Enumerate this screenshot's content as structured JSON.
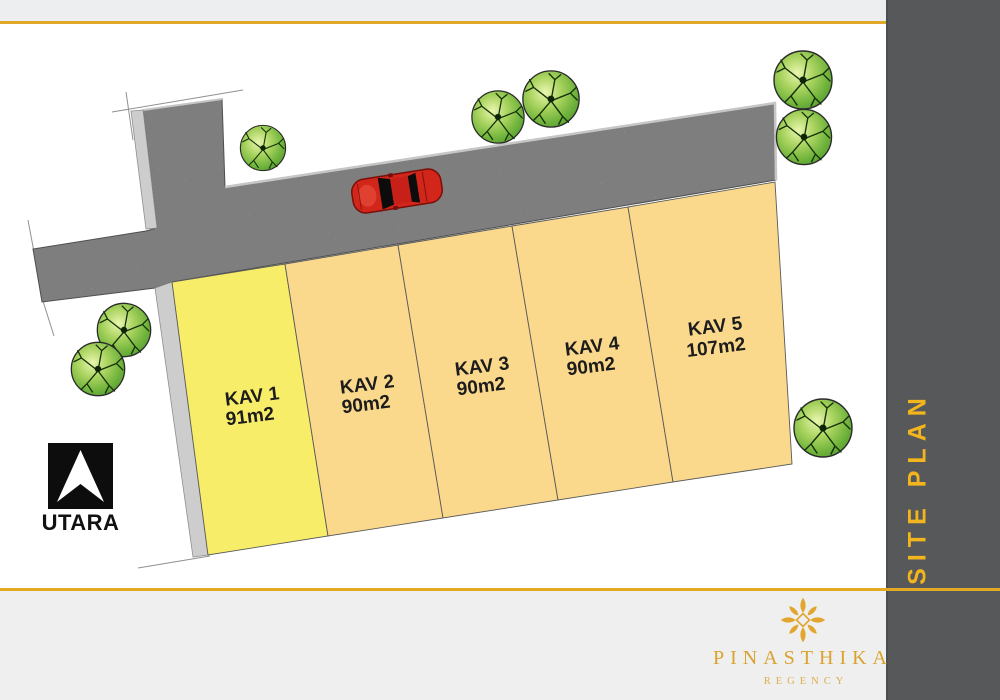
{
  "top_bar": {
    "bg": "#EDEEEF",
    "accent_color": "#DFA828"
  },
  "sidebar": {
    "bg": "#575859",
    "text_color": "#F2B51E",
    "title_word1": "SITE",
    "title_word2": "PLAN"
  },
  "footer": {
    "bg": "#F0EFF0",
    "accent_line_color": "#E3A922",
    "brand": "PINASTHIKA",
    "brand_sub": "REGENCY",
    "brand_color": "#D9A32E"
  },
  "site_plan": {
    "north_label": "UTARA",
    "road_color": "#7E7E7E",
    "sidewalk_color": "#CDCDCD",
    "car_color": "#D3261A",
    "tree_color": "#6FB33B",
    "plots": [
      {
        "id": "KAV 1",
        "area": "91m2",
        "fill": "#F8ED68"
      },
      {
        "id": "KAV 2",
        "area": "90m2",
        "fill": "#FAD98C"
      },
      {
        "id": "KAV 3",
        "area": "90m2",
        "fill": "#FAD98C"
      },
      {
        "id": "KAV 4",
        "area": "90m2",
        "fill": "#FAD98C"
      },
      {
        "id": "KAV 5",
        "area": "107m2",
        "fill": "#FAD98C"
      }
    ]
  }
}
